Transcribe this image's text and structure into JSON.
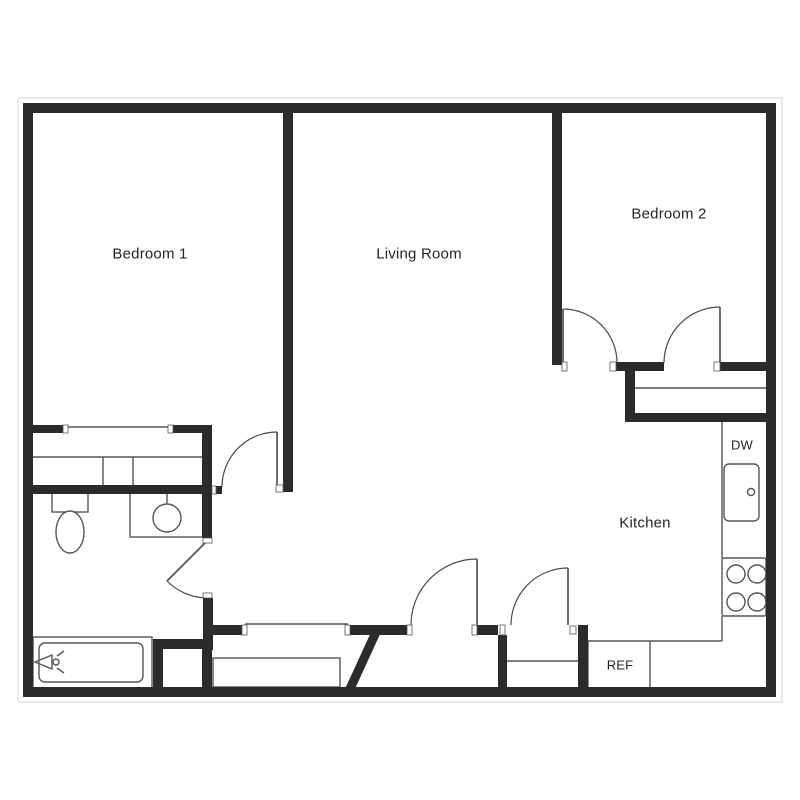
{
  "plan": {
    "canvas": {
      "w": 800,
      "h": 800,
      "background": "#ffffff"
    },
    "colors": {
      "wall": "#2b2b2b",
      "line": "#555555",
      "door": "#4a4a4a",
      "halo": "#e3e3e3",
      "text": "#252525"
    },
    "labels": [
      {
        "id": "bedroom-1",
        "text": "Bedroom 1",
        "x": 150,
        "y": 254,
        "size": 15
      },
      {
        "id": "living-room",
        "text": "Living Room",
        "x": 419,
        "y": 254,
        "size": 15
      },
      {
        "id": "bedroom-2",
        "text": "Bedroom 2",
        "x": 669,
        "y": 214,
        "size": 15
      },
      {
        "id": "kitchen",
        "text": "Kitchen",
        "x": 645,
        "y": 523,
        "size": 15
      },
      {
        "id": "dishwasher",
        "text": "DW",
        "x": 742,
        "y": 445,
        "size": 13
      },
      {
        "id": "refrigerator",
        "text": "REF",
        "x": 620,
        "y": 665,
        "size": 13
      }
    ],
    "halo": {
      "x": 18,
      "y": 98,
      "w": 764,
      "h": 604
    },
    "walls": [
      {
        "x": 23,
        "y": 103,
        "w": 753,
        "h": 10
      },
      {
        "x": 23,
        "y": 103,
        "w": 10,
        "h": 594
      },
      {
        "x": 766,
        "y": 103,
        "w": 10,
        "h": 594
      },
      {
        "x": 23,
        "y": 687,
        "w": 753,
        "h": 10
      },
      {
        "x": 283,
        "y": 113,
        "w": 10,
        "h": 379
      },
      {
        "x": 552,
        "y": 113,
        "w": 10,
        "h": 252
      },
      {
        "x": 615,
        "y": 362,
        "w": 49,
        "h": 9
      },
      {
        "x": 720,
        "y": 362,
        "w": 46,
        "h": 9
      },
      {
        "x": 625,
        "y": 366,
        "w": 10,
        "h": 56
      },
      {
        "x": 625,
        "y": 413,
        "w": 141,
        "h": 9
      },
      {
        "x": 33,
        "y": 425,
        "w": 30,
        "h": 8
      },
      {
        "x": 173,
        "y": 425,
        "w": 37,
        "h": 8
      },
      {
        "x": 202,
        "y": 425,
        "w": 10,
        "h": 113
      },
      {
        "x": 33,
        "y": 485,
        "w": 179,
        "h": 9
      },
      {
        "x": 216,
        "y": 486,
        "w": 6,
        "h": 8
      },
      {
        "x": 203,
        "y": 598,
        "w": 10,
        "h": 52
      },
      {
        "x": 213,
        "y": 625,
        "w": 29,
        "h": 10
      },
      {
        "x": 350,
        "y": 625,
        "w": 57,
        "h": 10
      },
      {
        "x": 477,
        "y": 625,
        "w": 21,
        "h": 10
      },
      {
        "x": 498,
        "y": 635,
        "w": 9,
        "h": 52
      },
      {
        "x": 578,
        "y": 625,
        "w": 10,
        "h": 62
      },
      {
        "x": 153,
        "y": 639,
        "w": 59,
        "h": 10
      },
      {
        "x": 153,
        "y": 649,
        "w": 10,
        "h": 38
      },
      {
        "x": 202,
        "y": 649,
        "w": 10,
        "h": 38
      }
    ],
    "diagonal_walls": [
      {
        "x1": 377,
        "y1": 630,
        "x2": 349,
        "y2": 691,
        "w": 9
      }
    ],
    "jambs": [
      {
        "x": 63,
        "y": 425,
        "w": 5,
        "h": 8
      },
      {
        "x": 168,
        "y": 425,
        "w": 5,
        "h": 8
      },
      {
        "x": 212,
        "y": 486,
        "w": 4,
        "h": 8
      },
      {
        "x": 276,
        "y": 485,
        "w": 7,
        "h": 7
      },
      {
        "x": 242,
        "y": 625,
        "w": 5,
        "h": 10
      },
      {
        "x": 345,
        "y": 625,
        "w": 5,
        "h": 10
      },
      {
        "x": 407,
        "y": 625,
        "w": 5,
        "h": 10
      },
      {
        "x": 472,
        "y": 625,
        "w": 5,
        "h": 10
      },
      {
        "x": 500,
        "y": 625,
        "w": 5,
        "h": 10
      },
      {
        "x": 570,
        "y": 626,
        "w": 6,
        "h": 8
      },
      {
        "x": 562,
        "y": 362,
        "w": 5,
        "h": 9
      },
      {
        "x": 610,
        "y": 362,
        "w": 6,
        "h": 9
      },
      {
        "x": 714,
        "y": 362,
        "w": 6,
        "h": 9
      },
      {
        "x": 203,
        "y": 538,
        "w": 9,
        "h": 5
      },
      {
        "x": 203,
        "y": 593,
        "w": 9,
        "h": 5
      }
    ],
    "outline_rects": [
      {
        "x": 213,
        "y": 658,
        "w": 127,
        "h": 29,
        "rx": 0
      },
      {
        "x": 33,
        "y": 637,
        "w": 119,
        "h": 51,
        "rx": 0
      },
      {
        "x": 39,
        "y": 643,
        "w": 104,
        "h": 39,
        "rx": 6
      },
      {
        "x": 130,
        "y": 493,
        "w": 75,
        "h": 44,
        "rx": 0
      },
      {
        "x": 52,
        "y": 493,
        "w": 36,
        "h": 19,
        "rx": 0
      },
      {
        "x": 724,
        "y": 464,
        "w": 35,
        "h": 57,
        "rx": 5
      },
      {
        "x": 722,
        "y": 558,
        "w": 44,
        "h": 58,
        "rx": 2
      }
    ],
    "thin_lines": [
      {
        "x1": 65,
        "y1": 427,
        "x2": 170,
        "y2": 427
      },
      {
        "x1": 33,
        "y1": 457,
        "x2": 202,
        "y2": 457
      },
      {
        "x1": 103,
        "y1": 457,
        "x2": 103,
        "y2": 485
      },
      {
        "x1": 133,
        "y1": 457,
        "x2": 133,
        "y2": 485
      },
      {
        "x1": 635,
        "y1": 388,
        "x2": 766,
        "y2": 388
      },
      {
        "x1": 722,
        "y1": 422,
        "x2": 722,
        "y2": 558
      },
      {
        "x1": 722,
        "y1": 616,
        "x2": 722,
        "y2": 641
      },
      {
        "x1": 588,
        "y1": 641,
        "x2": 722,
        "y2": 641
      },
      {
        "x1": 588,
        "y1": 641,
        "x2": 588,
        "y2": 687
      },
      {
        "x1": 650,
        "y1": 641,
        "x2": 650,
        "y2": 687
      },
      {
        "x1": 245,
        "y1": 624,
        "x2": 348,
        "y2": 624
      },
      {
        "x1": 507,
        "y1": 661,
        "x2": 578,
        "y2": 661
      },
      {
        "x1": 167,
        "y1": 494,
        "x2": 167,
        "y2": 508
      },
      {
        "x1": 57,
        "y1": 656,
        "x2": 64,
        "y2": 651
      },
      {
        "x1": 57,
        "y1": 668,
        "x2": 64,
        "y2": 673
      }
    ],
    "circles": [
      {
        "cx": 167,
        "cy": 518,
        "r": 14
      },
      {
        "cx": 751,
        "cy": 492,
        "r": 3.5
      },
      {
        "cx": 736,
        "cy": 574,
        "r": 9
      },
      {
        "cx": 757,
        "cy": 574,
        "r": 9
      },
      {
        "cx": 736,
        "cy": 602,
        "r": 9
      },
      {
        "cx": 757,
        "cy": 602,
        "r": 9
      },
      {
        "cx": 56,
        "cy": 662,
        "r": 3
      }
    ],
    "ellipses": [
      {
        "cx": 70,
        "cy": 532,
        "rx": 14,
        "ry": 21
      }
    ],
    "extra_paths": [
      {
        "d": "M52,655 L35,662 L52,669 Z"
      }
    ],
    "doors": [
      {
        "leaf": [
          563,
          363,
          563,
          309
        ],
        "arc": {
          "x1": 563,
          "y1": 309,
          "x2": 617,
          "y2": 363,
          "r": 54,
          "sweep": 1
        }
      },
      {
        "leaf": [
          720,
          363,
          720,
          307
        ],
        "arc": {
          "x1": 664,
          "y1": 363,
          "x2": 720,
          "y2": 307,
          "r": 56,
          "sweep": 1
        }
      },
      {
        "leaf": [
          477,
          625,
          477,
          559
        ],
        "arc": {
          "x1": 411,
          "y1": 625,
          "x2": 477,
          "y2": 559,
          "r": 66,
          "sweep": 1
        }
      },
      {
        "leaf": [
          568,
          625,
          568,
          568
        ],
        "arc": {
          "x1": 511,
          "y1": 625,
          "x2": 568,
          "y2": 568,
          "r": 57,
          "sweep": 1
        }
      },
      {
        "leaf": [
          277,
          487,
          277,
          432
        ],
        "arc": {
          "x1": 222,
          "y1": 487,
          "x2": 277,
          "y2": 432,
          "r": 55,
          "sweep": 1
        }
      },
      {
        "leaf": [
          207,
          541,
          167,
          581
        ],
        "arc": {
          "x1": 167,
          "y1": 581,
          "x2": 207,
          "y2": 598,
          "r": 57,
          "sweep": 0
        }
      }
    ]
  }
}
